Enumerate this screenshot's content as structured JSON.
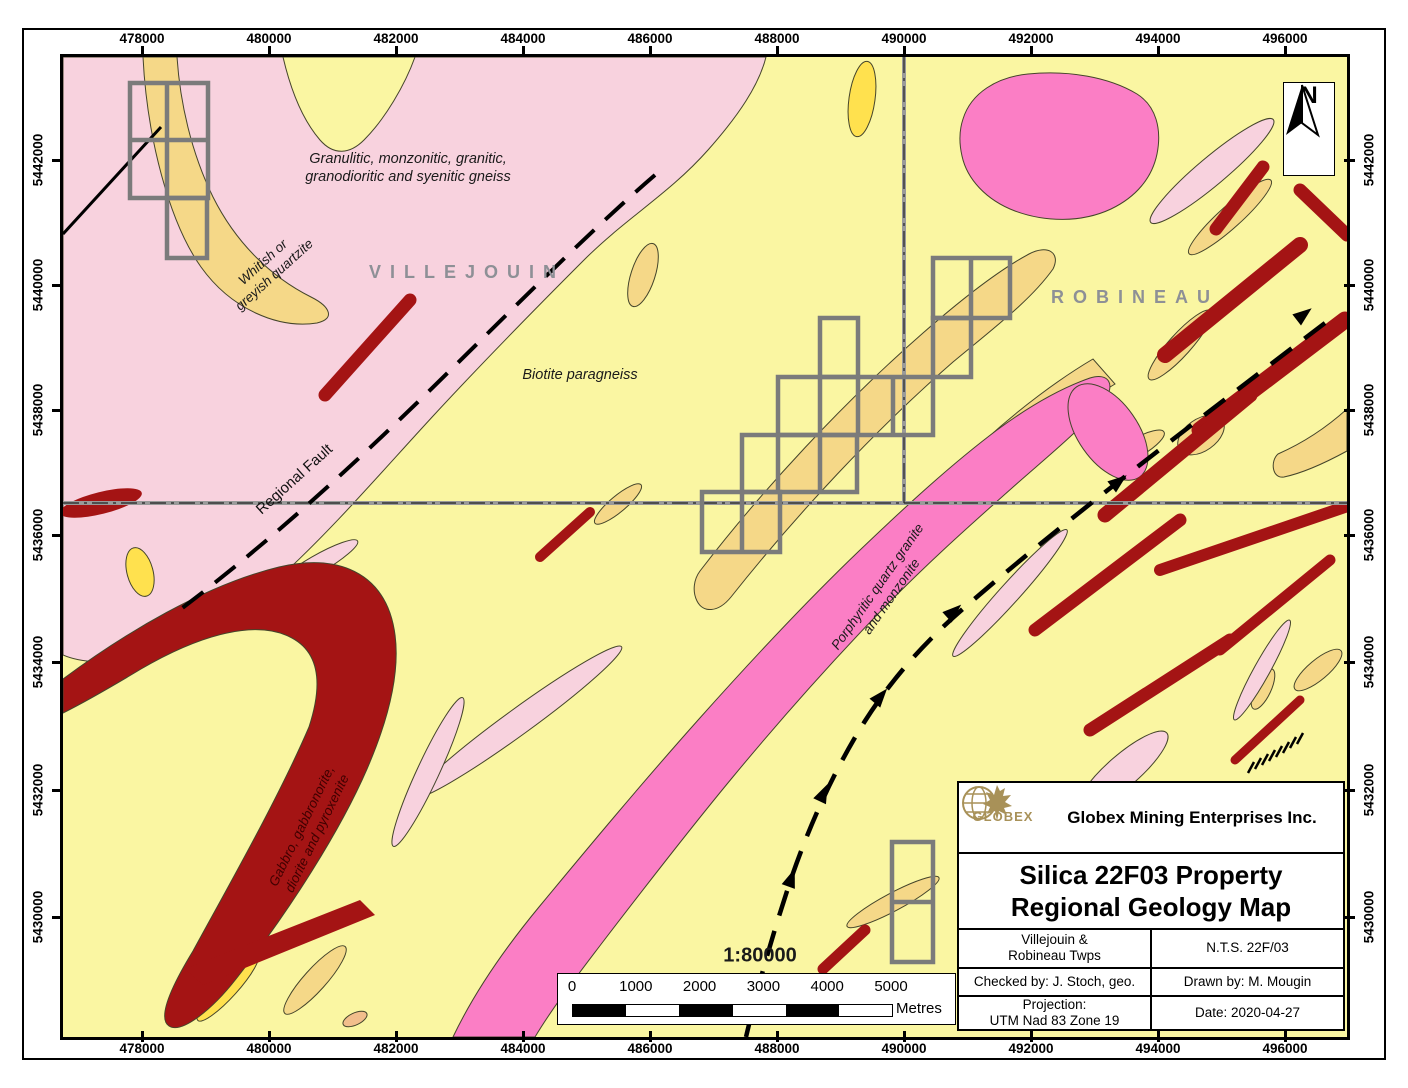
{
  "axes": {
    "easting": [
      "478000",
      "480000",
      "482000",
      "484000",
      "486000",
      "488000",
      "490000",
      "492000",
      "494000",
      "496000"
    ],
    "northing": [
      "5442000",
      "5440000",
      "5438000",
      "5436000",
      "5434000",
      "5432000",
      "5430000"
    ]
  },
  "map_labels": {
    "gneiss_line1": "Granulitic, monzonitic, granitic,",
    "gneiss_line2": "granodioritic and syenitic gneiss",
    "quartzite_line1": "Whitish or",
    "quartzite_line2": "greyish quartzite",
    "villejouin": "VILLEJOUIN",
    "robineau": "ROBINEAU",
    "biotite": "Biotite paragneiss",
    "regional_fault": "Regional Fault",
    "porphyritic_line1": "Porphyritic quartz granite",
    "porphyritic_line2": "and monzonite",
    "gabbro_line1": "Gabbro, gabbronorite,",
    "gabbro_line2": "diorite and pyroxenite",
    "north": "N"
  },
  "scalebar": {
    "ratio": "1:80000",
    "labels": [
      "0",
      "1000",
      "2000",
      "3000",
      "4000",
      "5000"
    ],
    "unit": "Metres"
  },
  "title_block": {
    "company": "Globex Mining Enterprises Inc.",
    "logo_text": "GLOBEX",
    "title_line1": "Silica 22F03 Property",
    "title_line2": "Regional Geology Map",
    "townships_line1": "Villejouin &",
    "townships_line2": "Robineau Twps",
    "nts": "N.T.S. 22F/03",
    "checked_by": "Checked by: J. Stoch, geo.",
    "drawn_by": "Drawn by: M. Mougin",
    "projection_line1": "Projection:",
    "projection_line2": "UTM Nad 83 Zone 19",
    "date": "Date: 2020-04-27"
  },
  "colors": {
    "yellow_background": "#FAF6A2",
    "pink_gneiss": "#F8D2DE",
    "tan_quartzite": "#F5D888",
    "bright_yellow": "#FFE14E",
    "magenta_granite": "#FB7EC5",
    "dark_red_gabbro": "#A41414",
    "salmon": "#F2BE8C",
    "claim_outline_gray": "#7B7B7B",
    "boundary_gray": "#9A9A9A",
    "logo_gold": "#A89158",
    "township_text_gray": "#8E9096"
  }
}
